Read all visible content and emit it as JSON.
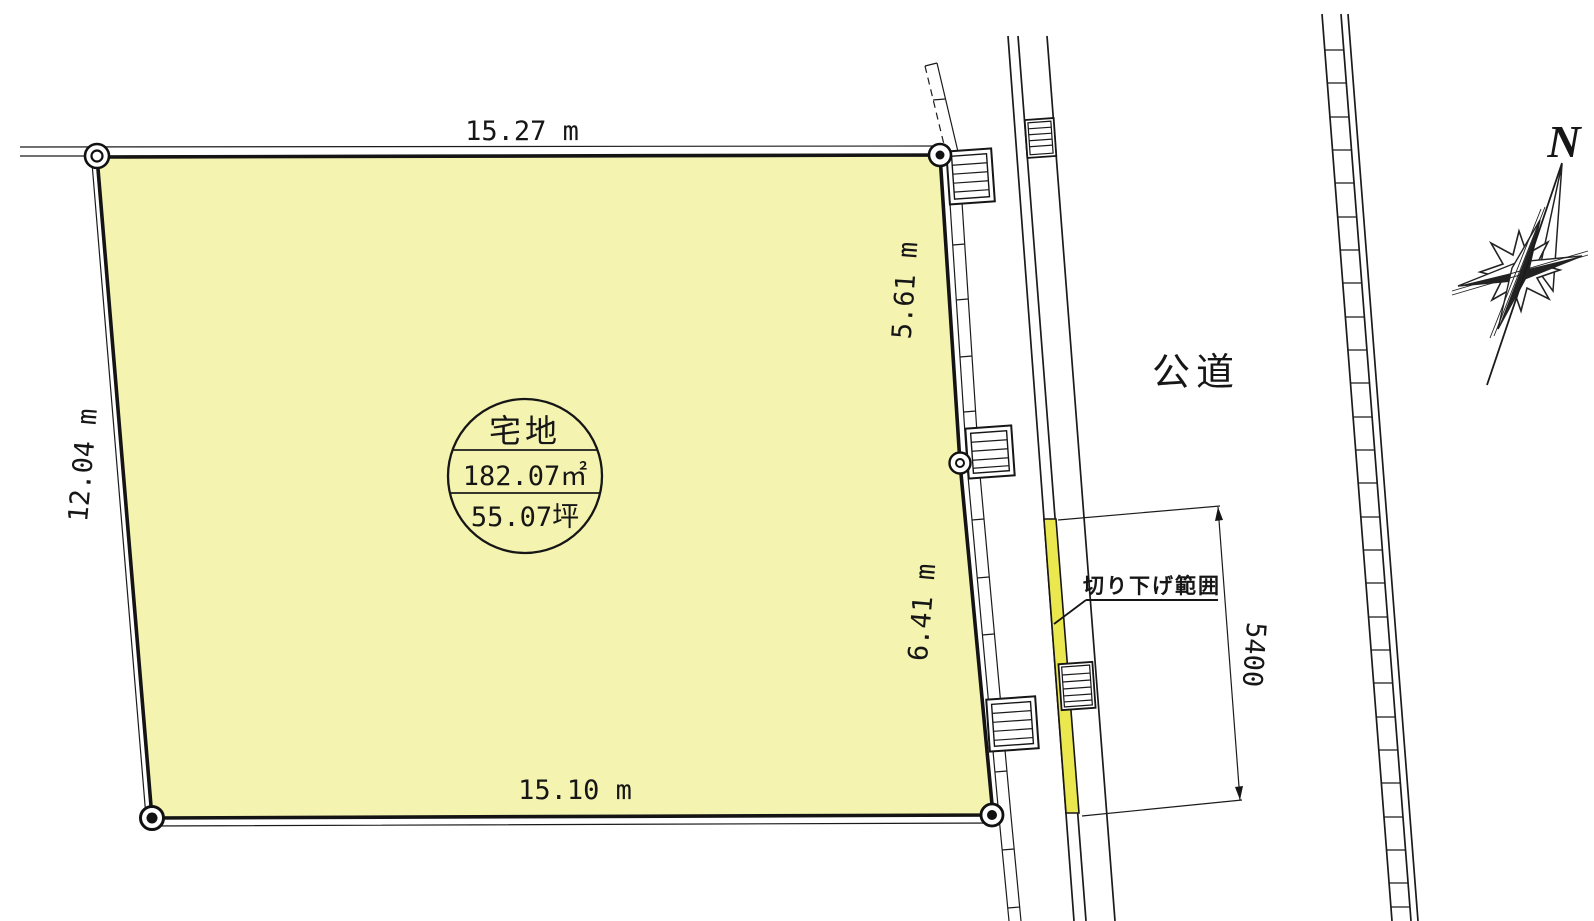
{
  "parcel": {
    "label": "宅地",
    "area_m2": "182.07㎡",
    "area_tsubo": "55.07坪",
    "fill_color": "#f4f3b0",
    "dims": {
      "top": "15.27 m",
      "left": "12.04 m",
      "right_upper": "5.61 m",
      "right_lower": "6.41 m",
      "bottom": "15.10 m"
    }
  },
  "road": {
    "label": "公道"
  },
  "curb_cut": {
    "label": "切り下げ範囲",
    "length_mm": "5400",
    "fill_color": "#ebe74e"
  },
  "compass": {
    "north": "N"
  },
  "colors": {
    "line": "#1b1b1b",
    "background": "#ffffff"
  }
}
